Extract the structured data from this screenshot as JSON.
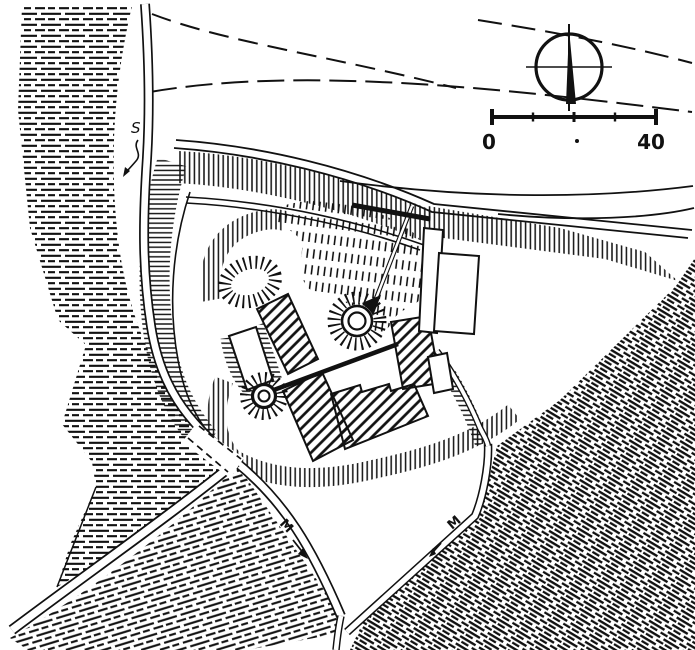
{
  "canvas": {
    "width": 695,
    "height": 650,
    "ink": "#111111",
    "paper": "#ffffff"
  },
  "scale_bar": {
    "start_label": "0",
    "end_label": "40"
  },
  "map_labels": {
    "spring": "S",
    "road_marker_west": "M",
    "road_marker_east": "M"
  },
  "icons": {
    "north_arrow": "compass-north-arrow",
    "scale_bar": "scale-bar",
    "spring_arrow": "spring-flow-arrow",
    "road_arrow_west": "road-direction-arrow",
    "road_arrow_east": "road-direction-arrow"
  }
}
